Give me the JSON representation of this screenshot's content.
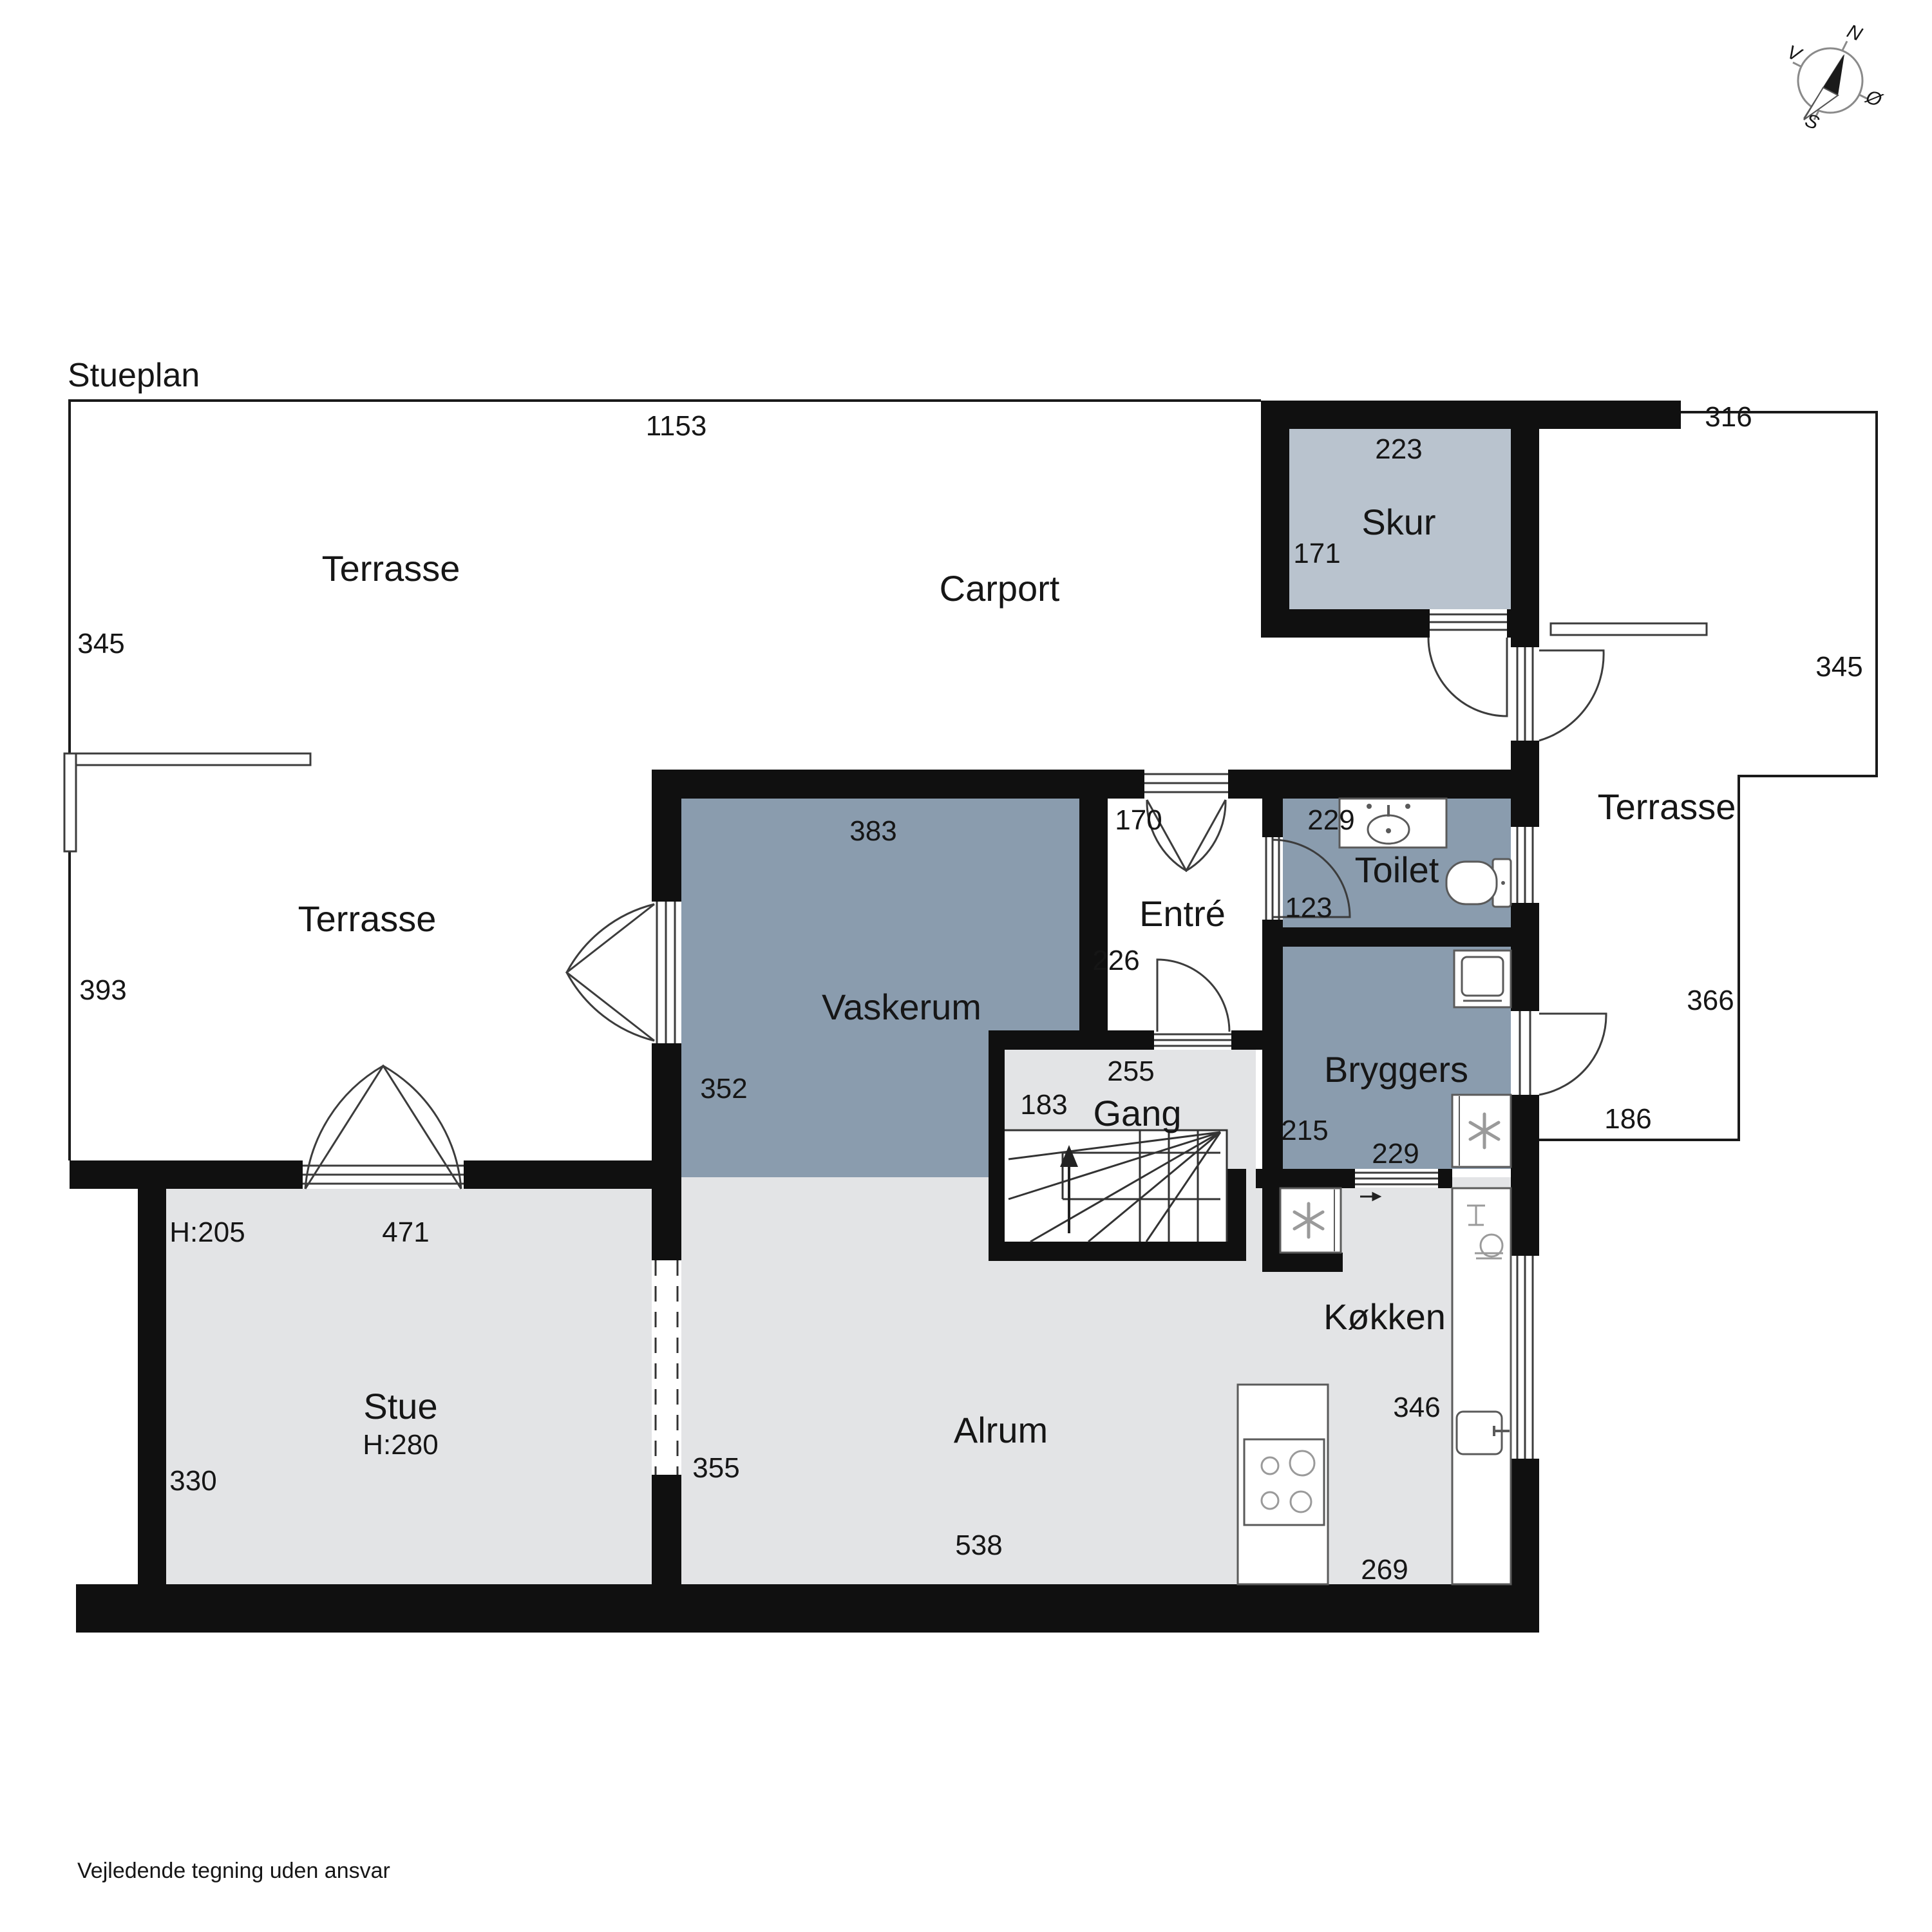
{
  "plan": {
    "title": "Stueplan",
    "footer": "Vejledende tegning uden ansvar"
  },
  "compass": {
    "n": "N",
    "e": "Ø",
    "s": "S",
    "w": "V"
  },
  "colors": {
    "wall": "#101010",
    "room_light": "#e3e4e6",
    "room_blue": "#8a9cae",
    "room_skur": "#b9c3ce"
  },
  "terrasse_nw": {
    "label": "Terrasse",
    "dim_top": "1153",
    "dim_side": "345"
  },
  "terrasse_w": {
    "label": "Terrasse",
    "dim_side": "393"
  },
  "terrasse_e": {
    "label": "Terrasse",
    "dim_top": "316",
    "dim_side": "345",
    "dim_bottom": "366",
    "dim_under": "186"
  },
  "carport": {
    "label": "Carport"
  },
  "skur": {
    "label": "Skur",
    "dim_w": "223",
    "dim_h": "171"
  },
  "vaskerum": {
    "label": "Vaskerum",
    "dim_w": "383",
    "dim_h": "352"
  },
  "entre": {
    "label": "Entré",
    "dim_door": "170",
    "dim_h": "226"
  },
  "toilet": {
    "label": "Toilet",
    "dim_w": "229",
    "dim_h": "123"
  },
  "bryggers": {
    "label": "Bryggers",
    "dim_h": "215",
    "dim_w": "229"
  },
  "gang": {
    "label": "Gang",
    "dim_w": "255",
    "dim_stair": "183"
  },
  "stue": {
    "label": "Stue",
    "ceiling": "H:280",
    "door_height": "H:205",
    "dim_w": "471",
    "dim_h": "330",
    "dim_open": "355"
  },
  "alrum": {
    "label": "Alrum",
    "dim_w": "538"
  },
  "kokken": {
    "label": "Køkken",
    "dim_h": "346",
    "dim_w": "269"
  }
}
